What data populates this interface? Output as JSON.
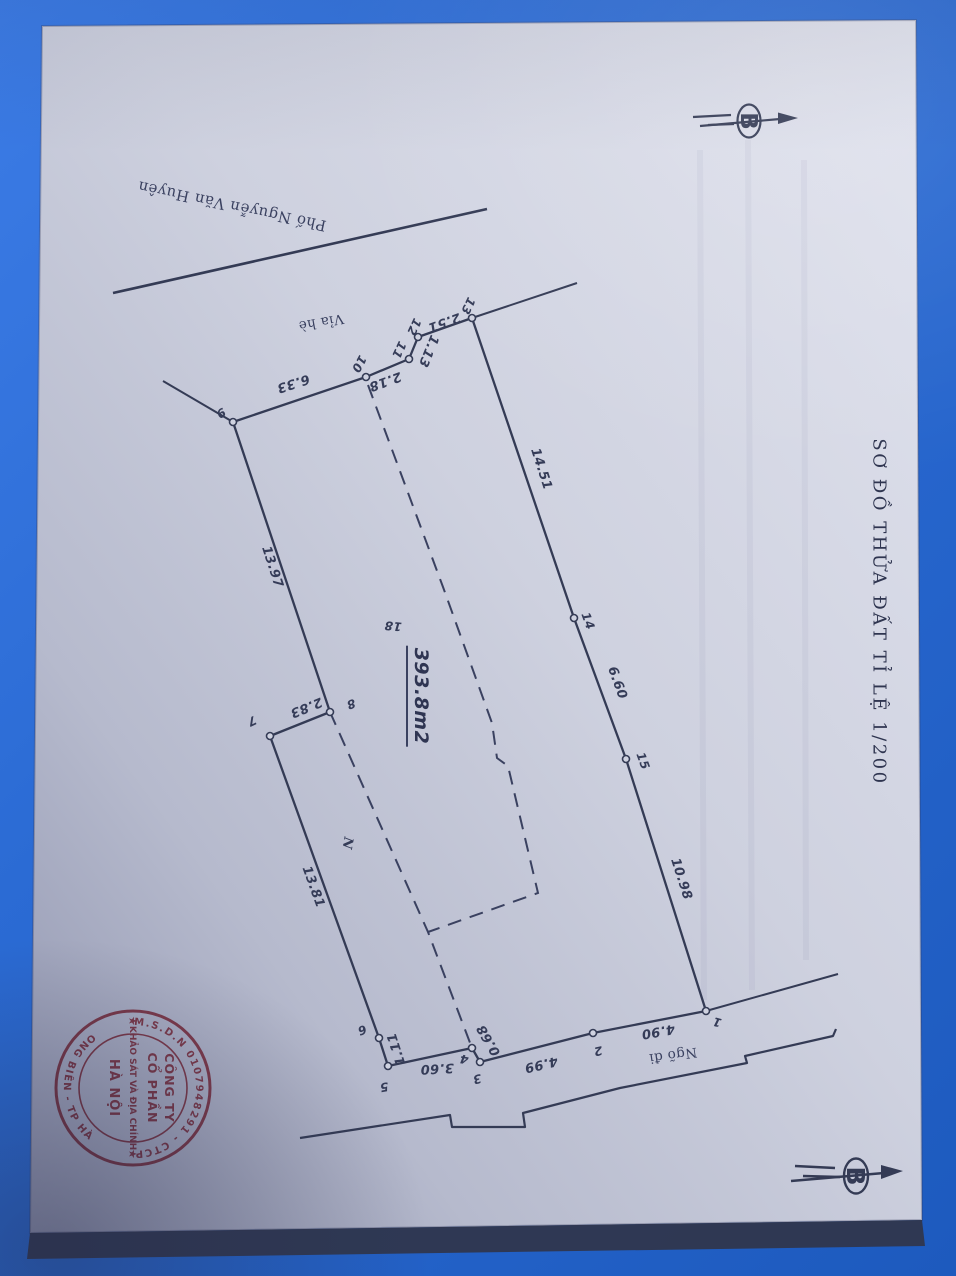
{
  "colors": {
    "background": "#2b6bd4",
    "paper": "#d3d6e3",
    "ink": "#343b55",
    "stamp_red": "#b13c4b"
  },
  "title": {
    "text": "SƠ ĐỒ THỬA ĐẤT TỈ LỆ 1/200"
  },
  "labels": {
    "street": "Phố Nguyễn Văn Huyên",
    "sidewalk": "Vỉa hè",
    "alley": "Ngõ đi",
    "area": "393.8m2",
    "parcel_number": "18",
    "house_mark": "N",
    "north_letter": "B"
  },
  "vertices": {
    "v1": "1",
    "v2": "2",
    "v3": "3",
    "v4": "4",
    "v5": "5",
    "v6": "6",
    "v7": "7",
    "v8": "8",
    "v9": "9",
    "v10": "10",
    "v11": "11",
    "v12": "12",
    "v13": "13",
    "v14": "14",
    "v15": "15"
  },
  "segments": {
    "s1_2": "4.90",
    "s2_3": "4.99",
    "s3_4": "0.68",
    "s4_5": "3.60",
    "s5_6": "1.11",
    "s6_7": "13.81",
    "s7_8": "2.83",
    "s8_9": "13.97",
    "s9_10": "6.33",
    "s10_11": "2.18",
    "s11_12": "1.13",
    "s12_13": "2.51",
    "s13_14": "14.51",
    "s14_15": "6.60",
    "s15_1": "10.98"
  },
  "stamp": {
    "ring_top": "M.S.D.N 0107948291 - CTCP",
    "ring_bottom": "Q. LONG BIÊN - TP HÀ NỘI",
    "line1": "CÔNG TY",
    "line2": "CỔ PHẦN",
    "line3": "KHẢO SÁT VÀ ĐỊA CHÍNH",
    "line4": "HÀ NỘI",
    "star": "★"
  }
}
